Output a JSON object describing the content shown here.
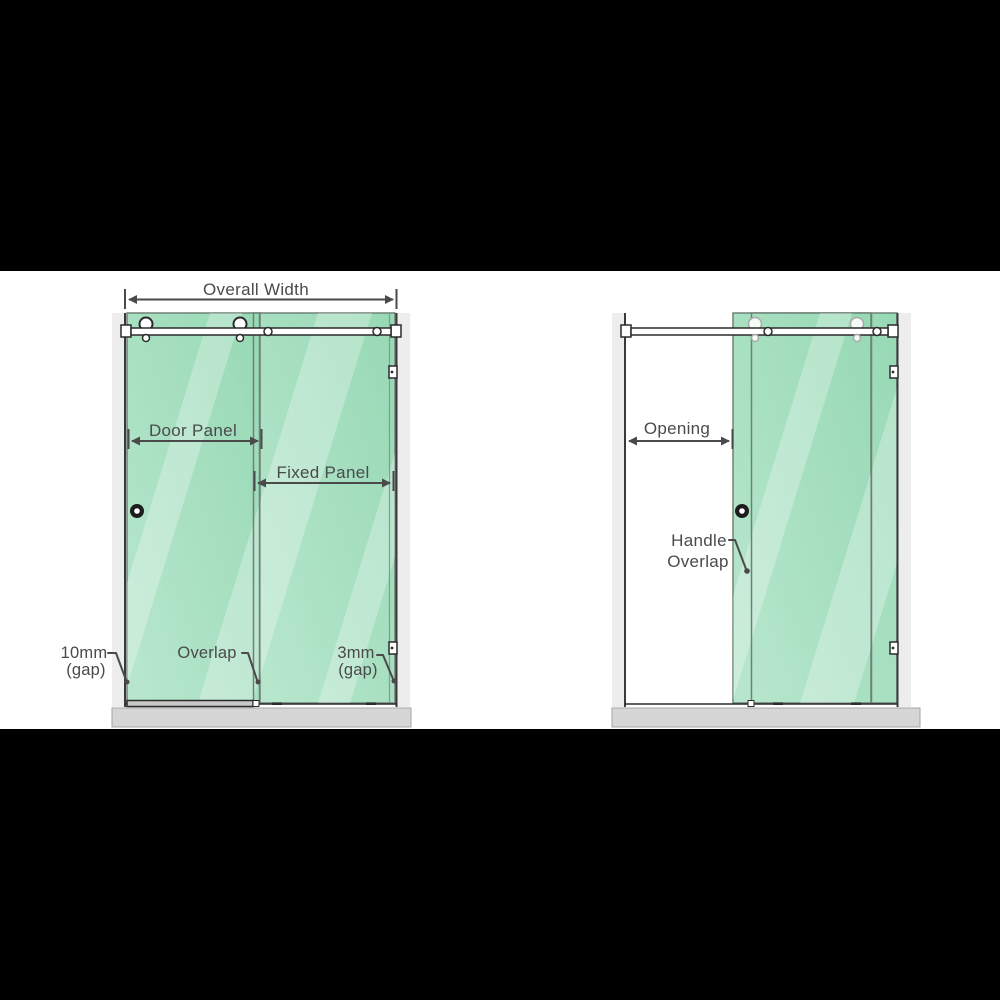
{
  "figure": {
    "left_diagram": {
      "overall_width_label": "Overall Width",
      "door_panel_label": "Door Panel",
      "fixed_panel_label": "Fixed Panel",
      "gap_left_line1": "10mm",
      "gap_left_line2": "(gap)",
      "overlap_label": "Overlap",
      "gap_right_line1": "3mm",
      "gap_right_line2": "(gap)"
    },
    "right_diagram": {
      "opening_label": "Opening",
      "handle_overlap_line1": "Handle",
      "handle_overlap_line2": "Overlap"
    }
  },
  "colors": {
    "glass_light": "#b9e7ce",
    "glass_dark": "#97d9b5",
    "streak": "#ffffff",
    "wall_shade": "#ededed",
    "floor": "#d6d6d6",
    "outline": "#2b2b2b",
    "label": "#4a4a4a",
    "letterbox": "#000000",
    "ghost_roller": "#a8a8a8"
  }
}
